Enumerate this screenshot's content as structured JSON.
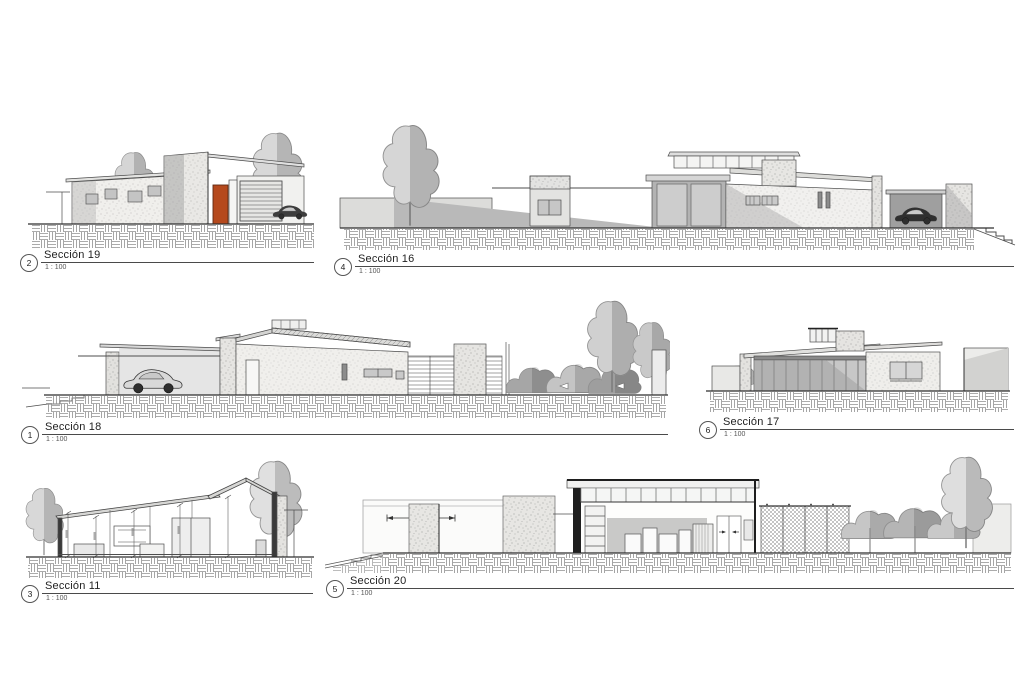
{
  "sheet": {
    "background": "#ffffff"
  },
  "colors": {
    "line": "#4d4d4d",
    "accent_door": "#b5491d",
    "wall_light": "#f0efec",
    "stucco": "#e7e6e3",
    "shadow_gray": "#a8a8a8",
    "tree_light": "#d2d2d2",
    "tree_dark": "#a0a0a0",
    "poche_black": "#1e1e1e"
  },
  "viewports": [
    {
      "key": "seccion-19",
      "number": "2",
      "title": "Sección 19",
      "scale": "1 : 100"
    },
    {
      "key": "seccion-16",
      "number": "4",
      "title": "Sección 16",
      "scale": "1 : 100"
    },
    {
      "key": "seccion-18",
      "number": "1",
      "title": "Sección 18",
      "scale": "1 : 100"
    },
    {
      "key": "seccion-17",
      "number": "6",
      "title": "Sección 17",
      "scale": "1 : 100"
    },
    {
      "key": "seccion-11",
      "number": "3",
      "title": "Sección 11",
      "scale": "1 : 100"
    },
    {
      "key": "seccion-20",
      "number": "5",
      "title": "Sección 20",
      "scale": "1 : 100"
    }
  ]
}
